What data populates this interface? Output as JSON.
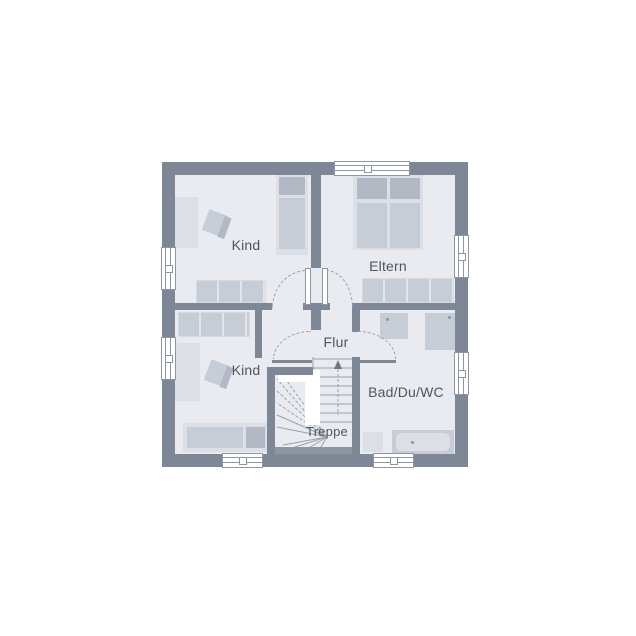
{
  "plan": {
    "rooms": {
      "kind_top": {
        "label": "Kind"
      },
      "eltern": {
        "label": "Eltern"
      },
      "flur": {
        "label": "Flur"
      },
      "kind_bottom": {
        "label": "Kind"
      },
      "bad": {
        "label": "Bad/Du/WC"
      },
      "treppe": {
        "label": "Treppe"
      }
    },
    "colors": {
      "page_bg": "#ffffff",
      "wall": "#7e8795",
      "floor": "#e9ebf0",
      "furn_light": "#dcdfe6",
      "furn_mid": "#c7cdd7",
      "furn_dark": "#b2b9c5",
      "window_frame": "#8e96a3",
      "door_arc": "#9aa2ad",
      "stair_line": "#9aa2ad",
      "stair_band": "#8d95a2",
      "text": "#4d5563"
    }
  }
}
